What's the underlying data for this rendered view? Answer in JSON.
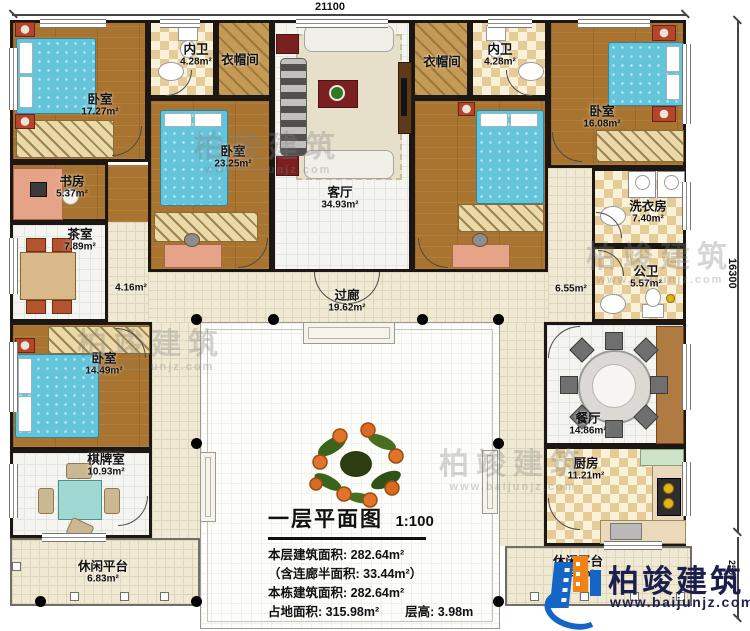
{
  "plan": {
    "title": "一层平面图",
    "scale": "1:100",
    "stats": [
      "本层建筑面积: 282.64m²",
      "（含连廊半面积: 33.44m²）",
      "本栋建筑面积: 282.64m²",
      "占地面积: 315.98m²",
      "层高: 3.98m"
    ]
  },
  "dimensions": {
    "top": "21100",
    "right": "16300",
    "right_lower": "2500"
  },
  "rooms": [
    {
      "name": "卧室",
      "area": "17.27m²"
    },
    {
      "name": "内卫",
      "area": "4.28m²"
    },
    {
      "name": "衣帽间",
      "area": ""
    },
    {
      "name": "卧室",
      "area": "23.25m²"
    },
    {
      "name": "客厅",
      "area": "34.93m²"
    },
    {
      "name": "衣帽间",
      "area": ""
    },
    {
      "name": "内卫",
      "area": "4.28m²"
    },
    {
      "name": "卧室",
      "area": "16.08m²"
    },
    {
      "name": "书房",
      "area": "5.37m²"
    },
    {
      "name": "茶室",
      "area": "7.89m²"
    },
    {
      "name": "",
      "area": "4.16m²"
    },
    {
      "name": "洗衣房",
      "area": "7.40m²"
    },
    {
      "name": "公卫",
      "area": "5.57m²"
    },
    {
      "name": "",
      "area": "6.55m²"
    },
    {
      "name": "过廊",
      "area": "19.62m²"
    },
    {
      "name": "卧室",
      "area": "14.49m²"
    },
    {
      "name": "棋牌室",
      "area": "10.93m²"
    },
    {
      "name": "休闲平台",
      "area": "6.83m²"
    },
    {
      "name": "餐厅",
      "area": "14.86m²"
    },
    {
      "name": "厨房",
      "area": "11.21m²"
    },
    {
      "name": "休闲平台",
      "area": "6.91m²"
    }
  ],
  "brand": {
    "name": "柏竣建筑",
    "url": "www.baijunjz.com"
  }
}
